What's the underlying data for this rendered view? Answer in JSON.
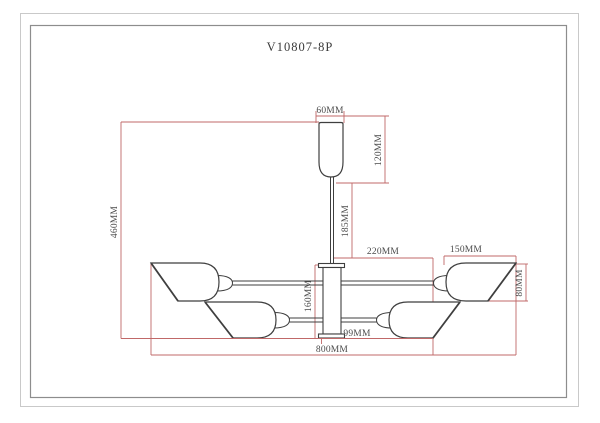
{
  "title": "V10807-8P",
  "units": "MM",
  "dims": {
    "canopy_width": "60MM",
    "canopy_height": "120MM",
    "stem_length": "185MM",
    "overall_height": "460MM",
    "center_to_shade": "220MM",
    "shade_length": "150MM",
    "shade_height": "80MM",
    "hub_height": "160MM",
    "hub_to_socket": "99MM",
    "overall_width": "800MM"
  },
  "colors": {
    "outline": "#3f3f3f",
    "dimension_line": "#c06868",
    "dimension_text": "#4a4a4a",
    "border_outer": "#c9c9c9",
    "border_inner": "#8d8d8d"
  }
}
